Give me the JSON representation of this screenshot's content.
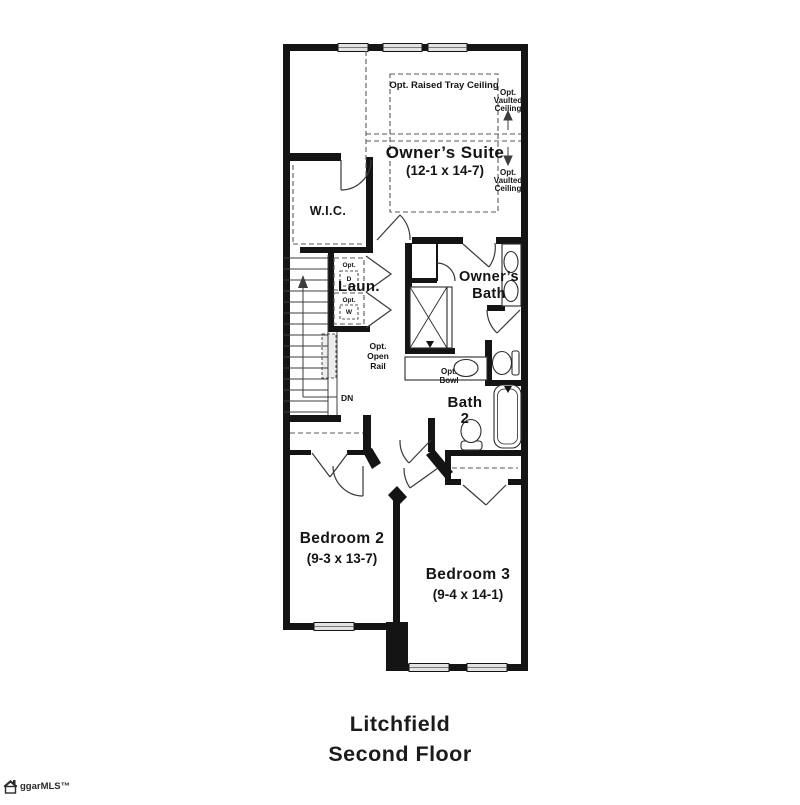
{
  "colors": {
    "ink": "#141414",
    "line": "#333333",
    "dash": "#5a5a5a",
    "window_fill": "#e3e3e3",
    "rail_fill": "#ededed",
    "background": "#ffffff"
  },
  "plan": {
    "rooms": {
      "owners_suite": {
        "name": "Owner’s Suite",
        "dims": "(12-1 x 14-7)"
      },
      "wic": {
        "name": "W.I.C."
      },
      "laundry": {
        "name": "Laun."
      },
      "owners_bath": {
        "lines": [
          "Owner’s",
          "Bath"
        ]
      },
      "bath_2": {
        "lines": [
          "Bath",
          "2"
        ]
      },
      "bedroom_2": {
        "name": "Bedroom 2",
        "dims": "(9-3 x 13-7)"
      },
      "bedroom_3": {
        "name": "Bedroom 3",
        "dims": "(9-4 x 14-1)"
      }
    },
    "annotations": {
      "tray_ceiling": "Opt. Raised Tray Ceiling",
      "vaulted_upper": [
        "Opt.",
        "Vaulted",
        "Ceiling"
      ],
      "vaulted_lower": [
        "Opt.",
        "Vaulted",
        "Ceiling"
      ],
      "open_rail": [
        "Opt.",
        "Open",
        "Rail"
      ],
      "down": "DN",
      "opt_bowl": [
        "Opt.",
        "Bowl"
      ],
      "opt_dryer": [
        "Opt.",
        "D"
      ],
      "opt_washer": [
        "Opt.",
        "W"
      ]
    }
  },
  "title": {
    "plan_name": "Litchfield",
    "floor_name": "Second Floor"
  },
  "watermark": {
    "text": "ggarMLS™"
  }
}
